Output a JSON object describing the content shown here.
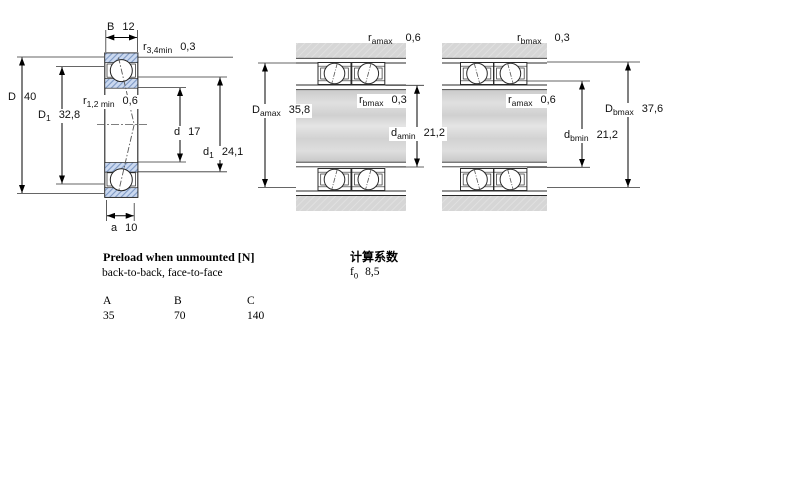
{
  "figure_left": {
    "B": {
      "sym": "B",
      "sub": "",
      "val": "12"
    },
    "r34": {
      "sym": "r",
      "sub": "3,4min",
      "val": "0,3"
    },
    "D": {
      "sym": "D",
      "sub": "",
      "val": "40"
    },
    "r12": {
      "sym": "r",
      "sub": "1,2 min",
      "val": "0,6"
    },
    "D1": {
      "sym": "D",
      "sub": "1",
      "val": "32,8"
    },
    "d": {
      "sym": "d",
      "sub": "",
      "val": "17"
    },
    "d1": {
      "sym": "d",
      "sub": "1",
      "val": "24,1"
    },
    "a": {
      "sym": "a",
      "sub": "",
      "val": "10"
    }
  },
  "figure_pairs": {
    "ra_top": {
      "sym": "r",
      "sub": "amax",
      "val": "0,6"
    },
    "rb_top": {
      "sym": "r",
      "sub": "bmax",
      "val": "0,3"
    },
    "Damax": {
      "sym": "D",
      "sub": "amax",
      "val": "35,8"
    },
    "rb_mid": {
      "sym": "r",
      "sub": "bmax",
      "val": "0,3"
    },
    "ra_mid": {
      "sym": "r",
      "sub": "amax",
      "val": "0,6"
    },
    "damin": {
      "sym": "d",
      "sub": "amin",
      "val": "21,2"
    },
    "dbmin": {
      "sym": "d",
      "sub": "bmin",
      "val": "21,2"
    },
    "Dbmax": {
      "sym": "D",
      "sub": "bmax",
      "val": "37,6"
    }
  },
  "preload_table": {
    "title": "Preload when unmounted [N]",
    "subtitle": "back-to-back, face-to-face",
    "columns": [
      "A",
      "B",
      "C"
    ],
    "values": [
      "35",
      "70",
      "140"
    ]
  },
  "calculation_factors": {
    "title": "计算系数",
    "f0": {
      "sym": "f",
      "sub": "0",
      "val": "8,5"
    }
  },
  "colors": {
    "ring_fill": "#cbd9f0",
    "ring_hatch": "#7e99c4",
    "housing_grey": "#d6d6d6",
    "line": "#1a1a1a"
  }
}
